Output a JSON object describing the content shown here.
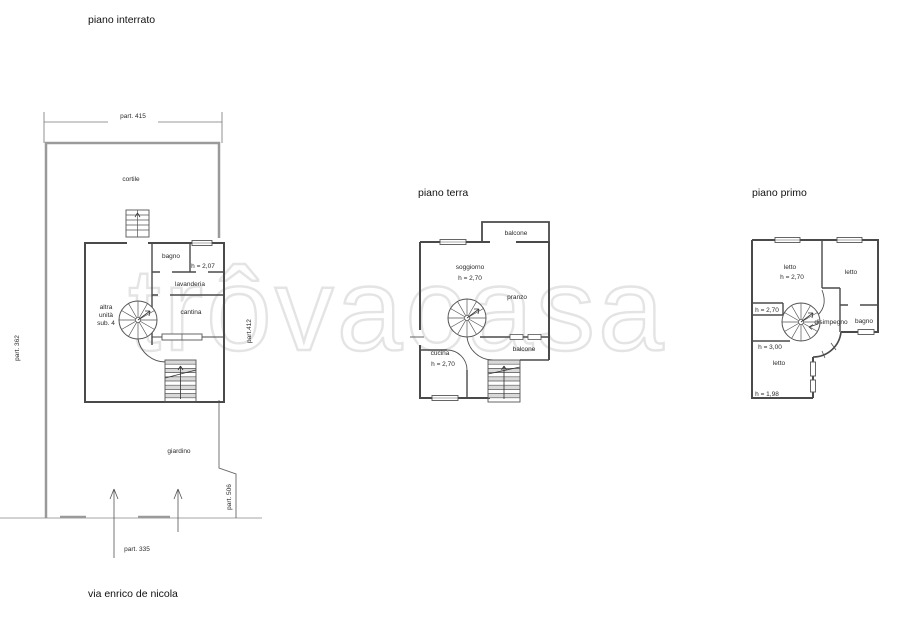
{
  "street_label": "via enrico de nicola",
  "watermark": "trôvacasa",
  "plans": {
    "interrato": {
      "title": "piano interrato",
      "labels": {
        "part_415": "part. 415",
        "part_362": "part. 362",
        "part_412": "part.412",
        "part_506": "part. 506",
        "part_335": "part. 335",
        "cortile": "cortile",
        "bagno": "bagno",
        "bagno_h": "h = 2,07",
        "lavanderia": "lavanderia",
        "altra_unita": [
          "altra",
          "unità",
          "sub. 4"
        ],
        "cantina": "cantina",
        "giardino": "giardino"
      }
    },
    "terra": {
      "title": "piano terra",
      "labels": {
        "balcone_top": "balcone",
        "soggiorno": "soggiorno",
        "soggiorno_h": "h = 2,70",
        "pranzo": "pranzo",
        "balcone_right": "balcone",
        "cucina": "cucina",
        "cucina_h": "h = 2,70"
      }
    },
    "primo": {
      "title": "piano primo",
      "labels": {
        "letto_1": "letto",
        "letto_1_h": "h = 2,70",
        "letto_2": "letto",
        "landing_h": "h = 2,70",
        "disimpegno": "disimpegno",
        "bagno": "bagno",
        "h_300": "h = 3,00",
        "letto_3": "letto",
        "h_198": "h = 1,98"
      }
    }
  }
}
